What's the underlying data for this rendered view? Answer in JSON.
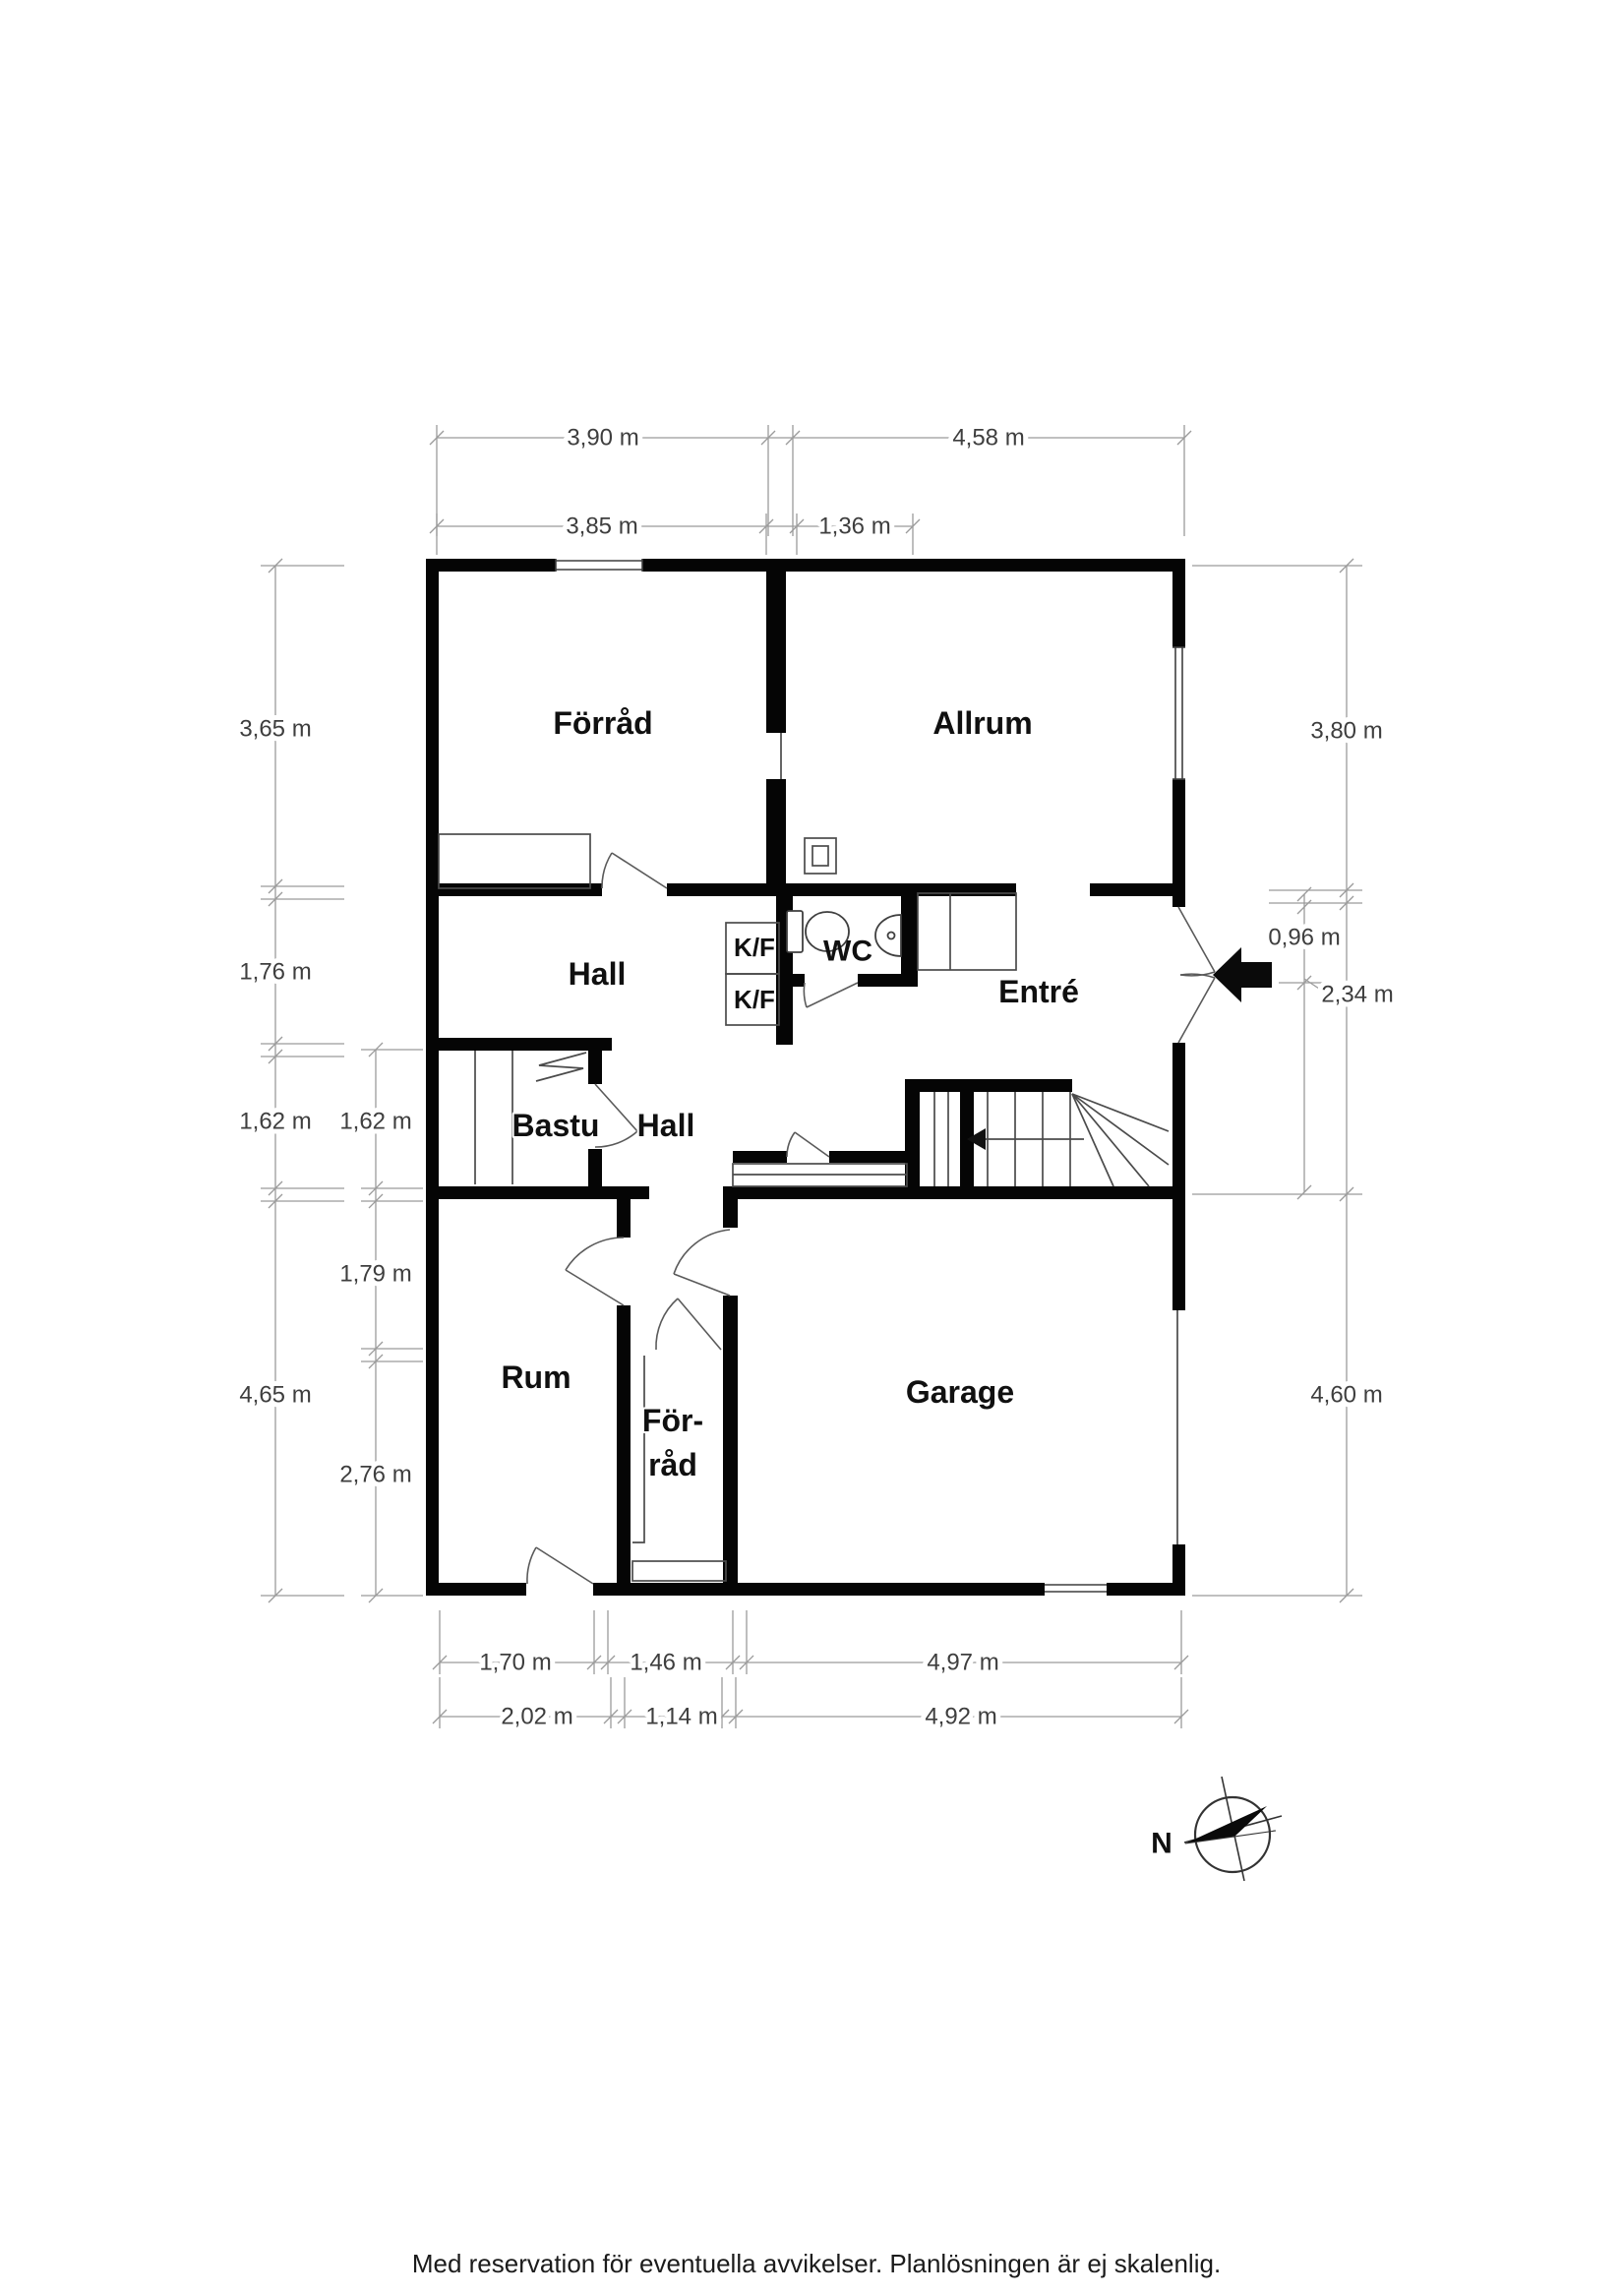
{
  "rooms": {
    "forrad_top": "Förråd",
    "allrum": "Allrum",
    "hall_upper": "Hall",
    "kf_top": "K/F",
    "kf_bottom": "K/F",
    "wc": "WC",
    "entre": "Entré",
    "bastu": "Bastu",
    "hall_lower": "Hall",
    "rum": "Rum",
    "forrad_lower_line1": "För-",
    "forrad_lower_line2": "råd",
    "garage": "Garage"
  },
  "dimensions": {
    "top": {
      "row1_left": "3,90 m",
      "row1_right": "4,58 m",
      "row2_left": "3,85 m",
      "row2_right": "1,36 m"
    },
    "left": {
      "outer_1": "3,65 m",
      "outer_2": "1,76 m",
      "outer_3": "1,62 m",
      "outer_4": "4,65 m",
      "inner_1": "1,62 m",
      "inner_2": "1,79 m",
      "inner_3": "2,76 m"
    },
    "right": {
      "outer_1": "3,80 m",
      "inner_1": "0,96 m",
      "inner_2": "2,34 m",
      "outer_2": "4,60 m"
    },
    "bottom": {
      "row1_1": "1,70 m",
      "row1_2": "1,46 m",
      "row1_3": "4,97 m",
      "row2_1": "2,02 m",
      "row2_2": "1,14 m",
      "row2_3": "4,92 m"
    }
  },
  "compass": {
    "north_label": "N"
  },
  "footer": {
    "disclaimer": "Med reservation för eventuella avvikelser. Planlösningen är ej skalenlig."
  }
}
